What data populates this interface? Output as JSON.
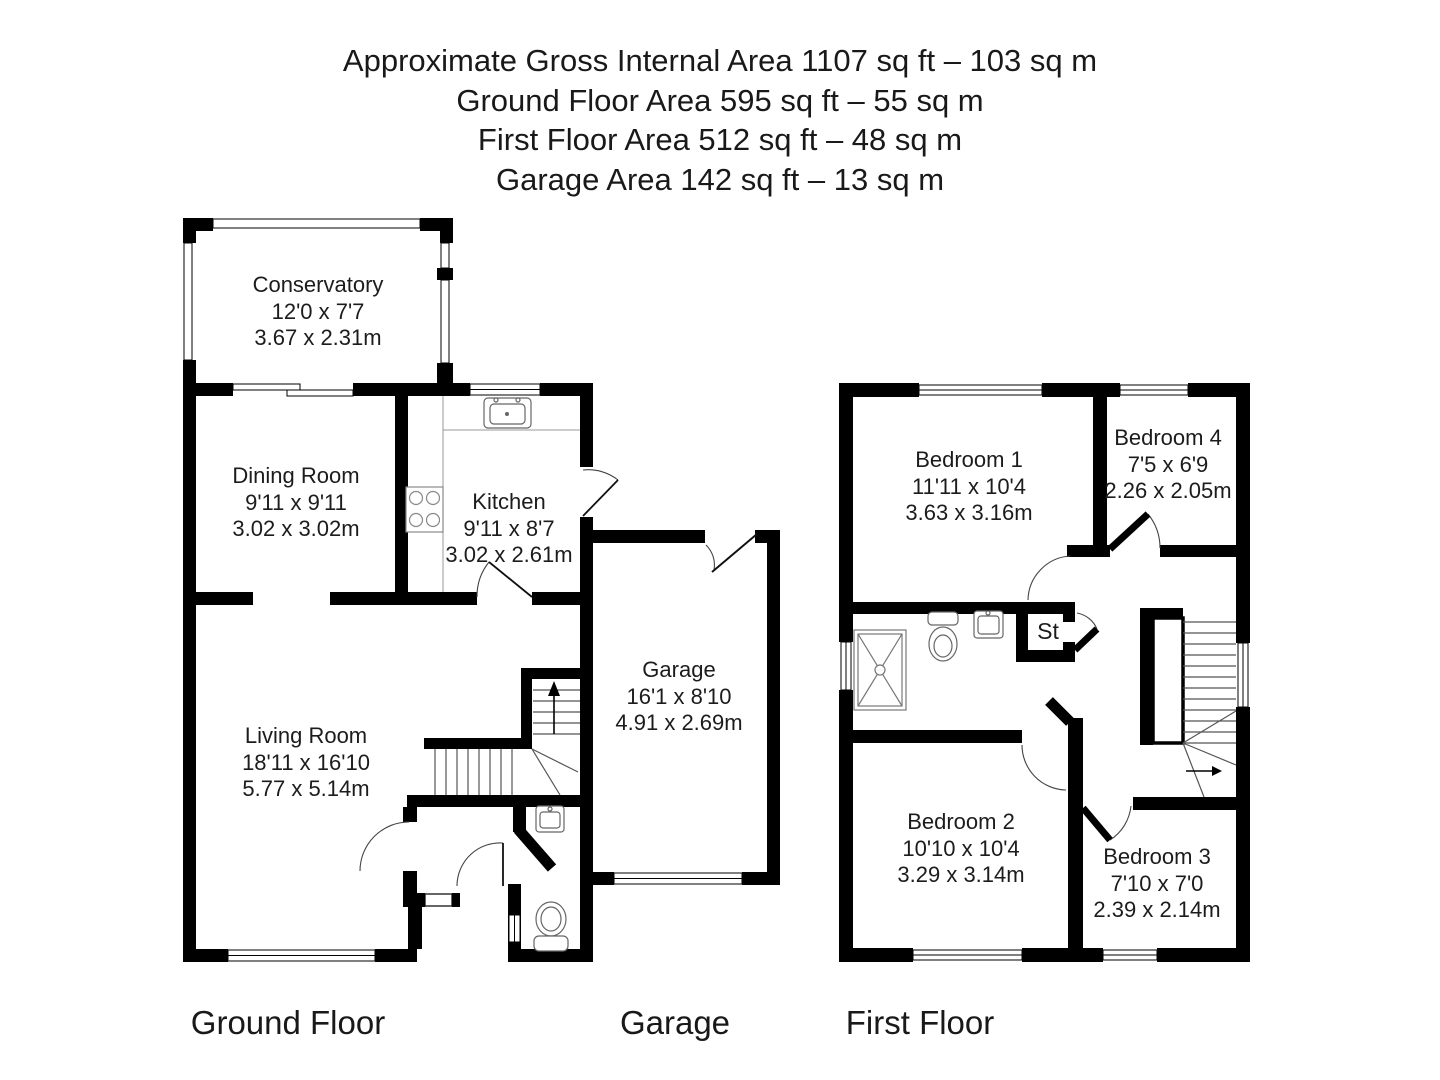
{
  "title_block": {
    "lines": [
      "Approximate Gross Internal Area 1107 sq ft – 103 sq m",
      "Ground Floor Area 595 sq ft – 55 sq m",
      "First Floor Area 512 sq ft – 48 sq m",
      "Garage Area 142 sq ft – 13 sq m"
    ]
  },
  "rooms": {
    "conservatory": {
      "name": "Conservatory",
      "size_imperial": "12'0 x 7'7",
      "size_metric": "3.67 x 2.31m"
    },
    "dining_room": {
      "name": "Dining Room",
      "size_imperial": "9'11 x 9'11",
      "size_metric": "3.02 x 3.02m"
    },
    "kitchen": {
      "name": "Kitchen",
      "size_imperial": "9'11 x 8'7",
      "size_metric": "3.02 x 2.61m"
    },
    "living_room": {
      "name": "Living Room",
      "size_imperial": "18'11 x 16'10",
      "size_metric": "5.77 x 5.14m"
    },
    "garage": {
      "name": "Garage",
      "size_imperial": "16'1 x 8'10",
      "size_metric": "4.91 x 2.69m"
    },
    "bedroom_1": {
      "name": "Bedroom 1",
      "size_imperial": "11'11 x 10'4",
      "size_metric": "3.63 x 3.16m"
    },
    "bedroom_2": {
      "name": "Bedroom 2",
      "size_imperial": "10'10 x 10'4",
      "size_metric": "3.29 x 3.14m"
    },
    "bedroom_3": {
      "name": "Bedroom 3",
      "size_imperial": "7'10 x 7'0",
      "size_metric": "2.39 x 2.14m"
    },
    "bedroom_4": {
      "name": "Bedroom 4",
      "size_imperial": "7'5 x 6'9",
      "size_metric": "2.26 x 2.05m"
    },
    "store": {
      "label": "St"
    }
  },
  "floor_labels": {
    "ground": "Ground Floor",
    "garage": "Garage",
    "first": "First Floor"
  },
  "colors": {
    "wall": "#000000",
    "background": "#ffffff",
    "fixture_line": "#777777",
    "detail_line": "#555555"
  }
}
